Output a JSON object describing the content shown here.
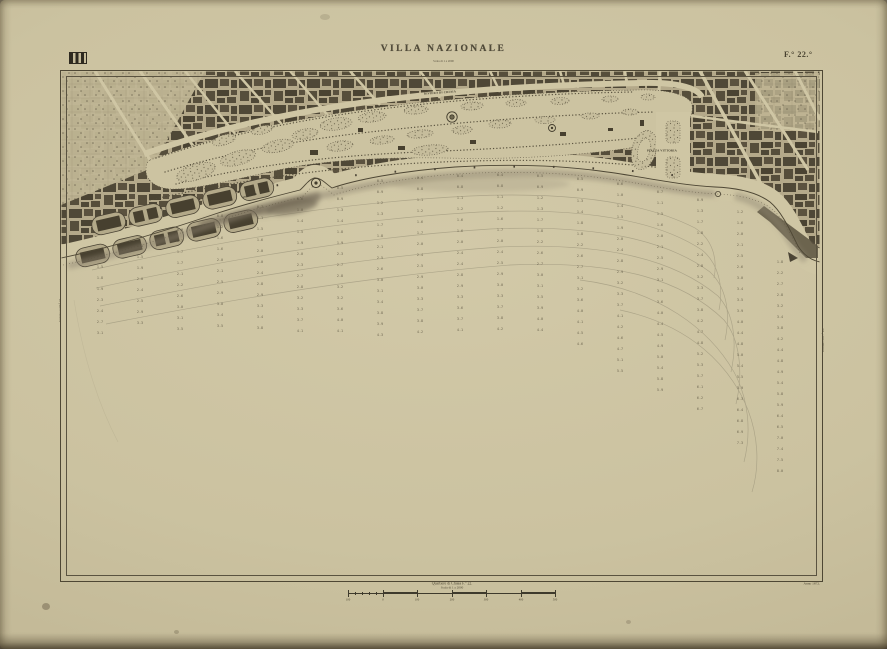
{
  "sheet": {
    "title": "VILLA NAZIONALE",
    "subtitle": "Scala di 1 a 2000",
    "sheet_number": "F.° 22.°",
    "anno": "Anno 1872.",
    "left_join_label": "Unione col F.° 21.",
    "right_join_label": "Unione col F.° 23."
  },
  "icons": {
    "stamp": "collection-stamp"
  },
  "map": {
    "labels": [
      {
        "text": "PIAZZA VITTORIA",
        "x": 662,
        "y": 151,
        "rot": 0,
        "size": 6,
        "scale": 0.5
      },
      {
        "text": "RIVIERA DI CHIAIA",
        "x": 440,
        "y": 93,
        "rot": -4,
        "size": 6,
        "scale": 0.5
      },
      {
        "text": "SPIAGGIA",
        "x": 250,
        "y": 196,
        "rot": -14,
        "size": 6,
        "scale": 0.45
      }
    ]
  },
  "sea": {
    "row_spacing": 11,
    "sounding_columns": [
      {
        "x": 100,
        "y0": 256,
        "y1": 333,
        "d0": 1.2,
        "d1": 3.0
      },
      {
        "x": 140,
        "y0": 246,
        "y1": 333,
        "d0": 1.2,
        "d1": 3.2
      },
      {
        "x": 180,
        "y0": 230,
        "y1": 335,
        "d0": 1.0,
        "d1": 3.4
      },
      {
        "x": 220,
        "y0": 216,
        "y1": 336,
        "d0": 0.9,
        "d1": 3.6
      },
      {
        "x": 260,
        "y0": 207,
        "y1": 338,
        "d0": 0.8,
        "d1": 3.8
      },
      {
        "x": 300,
        "y0": 199,
        "y1": 340,
        "d0": 0.7,
        "d1": 4.0
      },
      {
        "x": 340,
        "y0": 188,
        "y1": 340,
        "d0": 0.6,
        "d1": 4.2
      },
      {
        "x": 380,
        "y0": 181,
        "y1": 336,
        "d0": 0.6,
        "d1": 4.2
      },
      {
        "x": 420,
        "y0": 178,
        "y1": 332,
        "d0": 0.5,
        "d1": 4.1
      },
      {
        "x": 460,
        "y0": 176,
        "y1": 330,
        "d0": 0.5,
        "d1": 4.0
      },
      {
        "x": 500,
        "y0": 175,
        "y1": 333,
        "d0": 0.5,
        "d1": 4.1
      },
      {
        "x": 540,
        "y0": 176,
        "y1": 338,
        "d0": 0.6,
        "d1": 4.3
      },
      {
        "x": 580,
        "y0": 179,
        "y1": 350,
        "d0": 0.6,
        "d1": 4.7
      },
      {
        "x": 620,
        "y0": 184,
        "y1": 372,
        "d0": 0.7,
        "d1": 5.4
      },
      {
        "x": 660,
        "y0": 192,
        "y1": 394,
        "d0": 0.8,
        "d1": 6.0
      },
      {
        "x": 700,
        "y0": 200,
        "y1": 414,
        "d0": 1.0,
        "d1": 6.6
      },
      {
        "x": 740,
        "y0": 212,
        "y1": 448,
        "d0": 1.3,
        "d1": 7.3
      },
      {
        "x": 780,
        "y0": 262,
        "y1": 472,
        "d0": 1.9,
        "d1": 7.9
      }
    ]
  },
  "footer": {
    "caption_line1": "Quartiere di Chiaia  F.° 22.",
    "caption_line2": "Scala di 1 a 2000",
    "scale_ticks": [
      "100",
      "0",
      "100",
      "200",
      "300",
      "400",
      "500"
    ]
  },
  "colors": {
    "paper": "#cbc2a0",
    "ink": "#4a4334",
    "city_block": "#4f4837",
    "sea_contour": "#908971"
  }
}
